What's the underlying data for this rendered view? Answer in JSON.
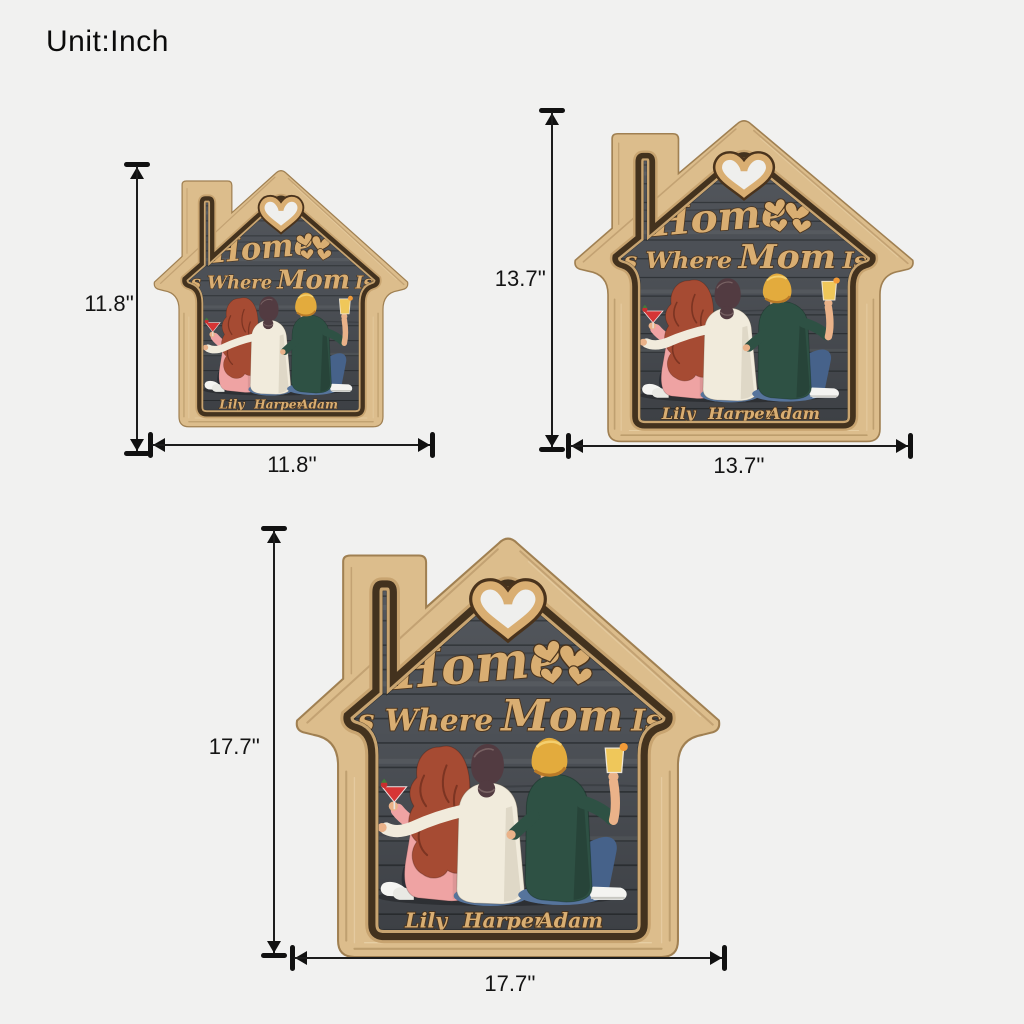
{
  "page": {
    "unit_label": "Unit:Inch",
    "background": "#f1f1f0"
  },
  "sign": {
    "title_word": "Home",
    "subtitle_prefix": "Is Where",
    "subtitle_emphasis": "Mom",
    "subtitle_suffix": "Is",
    "names": {
      "left": "Lily",
      "middle": "Harper",
      "right": "Adam"
    },
    "colors": {
      "frame_wood": "#dcbd8c",
      "frame_edge": "#a08052",
      "trim": "#43321e",
      "panel_dark": "#4d5157",
      "lettering": "#d9ae72",
      "heart_hole": "#efefed",
      "hair_red": "#a64b33",
      "hair_brown": "#523b41",
      "hair_blonde": "#e3ab3d",
      "sweater_pink": "#efa3a3",
      "sweater_cream": "#f1ebdc",
      "shirt_green": "#2e5144",
      "jeans_blue": "#56749c",
      "skin": "#eab289",
      "drink_red": "#d63535",
      "drink_yellow": "#efc75a",
      "dimension_ink": "#111111"
    }
  },
  "sizes": [
    {
      "name": "small",
      "height_label": "11.8''",
      "width_label": "11.8''"
    },
    {
      "name": "medium",
      "height_label": "13.7''",
      "width_label": "13.7''"
    },
    {
      "name": "large",
      "height_label": "17.7''",
      "width_label": "17.7''"
    }
  ]
}
